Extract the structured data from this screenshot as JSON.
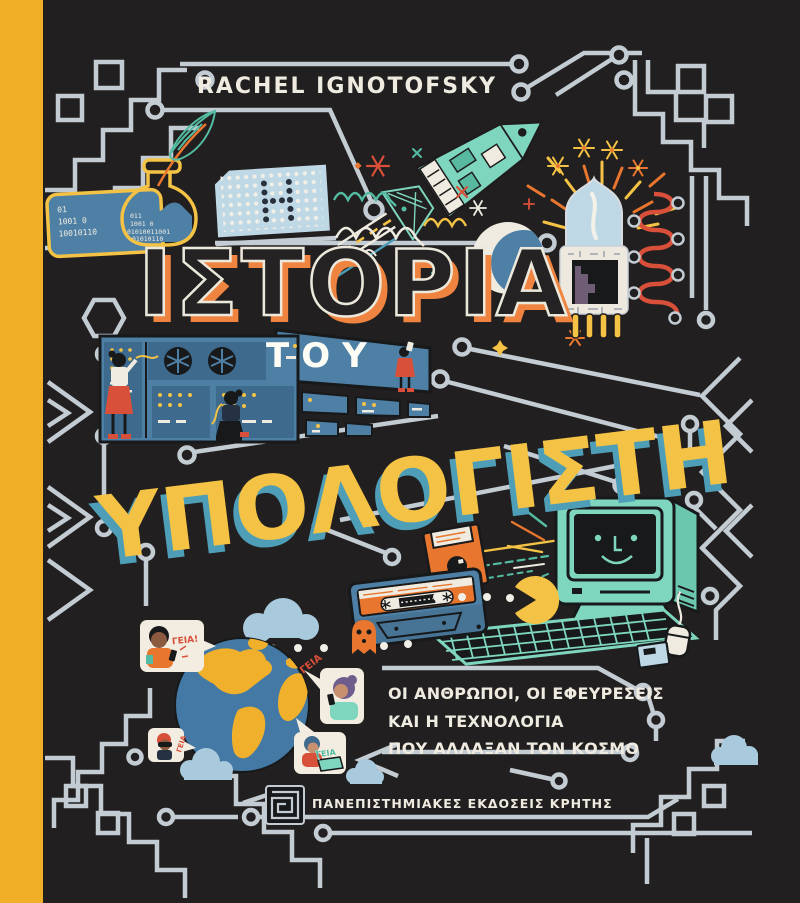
{
  "cover": {
    "author": "RACHEL IGNOTOFSKY",
    "title": {
      "word1": "ΙΣΤΟΡΙΑ",
      "article": "ΤΟΥ",
      "word2": "ΥΠΟΛΟΓΙΣΤΗ"
    },
    "subtitle": {
      "line1": "ΟΙ ΑΝΘΡΩΠΟΙ, ΟΙ ΕΦΕΥΡΕΣΕΙΣ",
      "line2": "ΚΑΙ Η ΤΕΧΝΟΛΟΓΙΑ",
      "line3": "ΠΟΥ ΑΛΛΑΞΑΝ ΤΟΝ ΚΟΣΜΟ"
    },
    "publisher": "ΠΑΝΕΠΙΣΤΗΜΙΑΚΕΣ ΕΚΔΟΣΕΙΣ ΚΡΗΤΗΣ",
    "punch_card_letter": "Η",
    "ink_bottle_binary": {
      "line1": "011",
      "line2": "1001 0",
      "line3": "01010011001",
      "line4": "01010110"
    },
    "binary_card": {
      "line1": "01",
      "line2": "1001 0",
      "line3": "10010110"
    },
    "greetings": {
      "bubble1": "ΓΕΙΑ!",
      "bubble2": "ΓΕΙΑ",
      "bubble3": "ΓΕΙΑ",
      "bubble4": "ΓΕΙΑ"
    },
    "colors": {
      "background": "#211F1F",
      "spine_yellow": "#F0AF26",
      "trace_gray": "#C3CBD3",
      "cream_white": "#EFEBE0",
      "accent_orange": "#EF8440",
      "accent_yellow": "#F4C244",
      "blue": "#4E80A6",
      "mint": "#7FD6BF",
      "red": "#D9503A",
      "light_blue": "#BFD8E6"
    }
  }
}
